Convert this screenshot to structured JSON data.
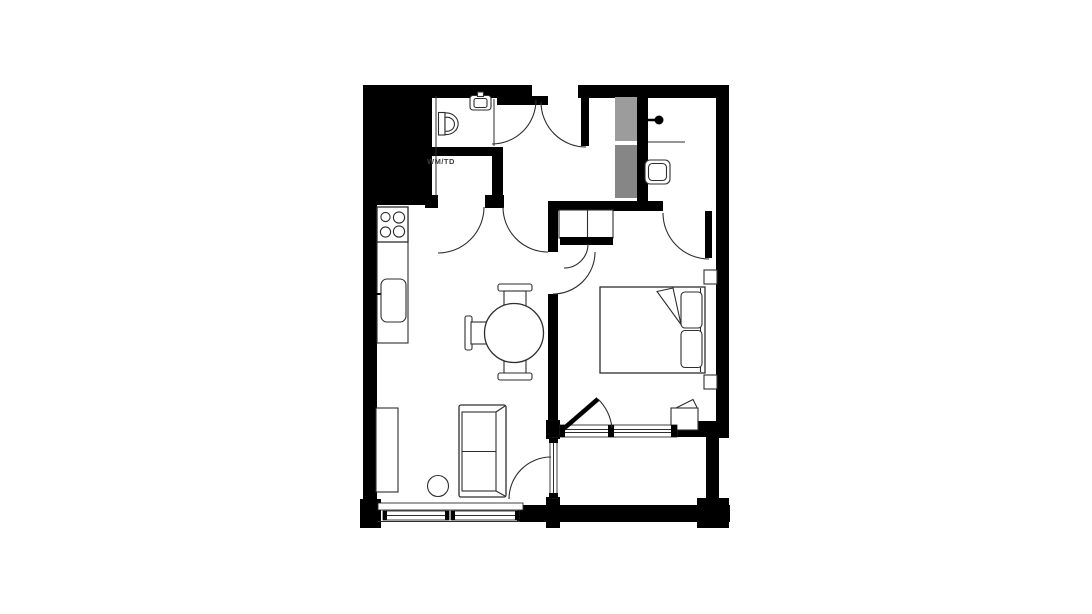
{
  "floorplan": {
    "labels": {
      "utility": "WM/TD"
    },
    "colors": {
      "background": "#ffffff",
      "walls": "#000000",
      "lines": "#2e2e2e",
      "duct_upper": "#9c9c9c",
      "duct_lower": "#868686",
      "label_text": "#3d3d3d"
    },
    "fixtures": [
      "toilet",
      "washbasin",
      "shower-head",
      "shower-screen",
      "utility-closet",
      "hob-4-burner",
      "kitchen-counter",
      "kitchen-sink",
      "dining-table",
      "dining-chair-top",
      "dining-chair-left",
      "dining-chair-bottom",
      "sofa",
      "tv-bench",
      "stool",
      "double-bed",
      "pillows",
      "wardrobe",
      "nightstand-top",
      "nightstand-bottom",
      "bedside-cabinet",
      "window-living",
      "window-bedroom",
      "balcony",
      "entrance-door",
      "bathroom-door",
      "bedroom-door",
      "ensuite-door",
      "balcony-doors"
    ]
  }
}
